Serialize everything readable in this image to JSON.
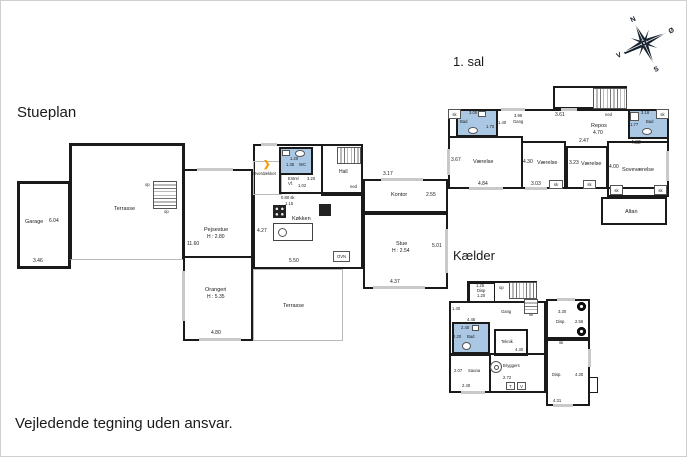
{
  "titles": {
    "ground": "Stueplan",
    "first": "1. sal",
    "basement": "Kælder"
  },
  "disclaimer": "Vejledende tegning uden ansvar.",
  "compass": {
    "north": "N",
    "east": "Ø",
    "south": "S",
    "west": "V"
  },
  "colors": {
    "bath_fill": "#aac7e4",
    "wall": "#1a1a1a",
    "window": "#c9c9c9",
    "entrance_arrow": "#f59a00"
  },
  "stueplan": {
    "garage": {
      "name": "Garage",
      "area": "6.04",
      "width": "3.46"
    },
    "terrasse_upper": {
      "name": "Terrasse",
      "stairs_up_1": "op",
      "stairs_up_2": "op"
    },
    "pejsestue": {
      "name": "Pejsestue",
      "ceiling": "H : 2.80",
      "side": "11.60"
    },
    "orangeri": {
      "name": "Orangeri",
      "ceiling": "H : 5.35",
      "width": "4.80"
    },
    "terrasse_lower": {
      "name": "Terrasse"
    },
    "overdaekket": {
      "name": "Overdækket"
    },
    "wc": {
      "name": "WC",
      "d1": "1.20",
      "d2": "1.35"
    },
    "entre": {
      "line1": "Entre/",
      "line2": "Vf.",
      "d1": "1.02",
      "d2": "3.20"
    },
    "hall": {
      "name": "Hall",
      "stairs": "ned"
    },
    "koekken": {
      "name": "Køkken",
      "island": "OPV",
      "oven": "OVN",
      "d1": "4.27",
      "d2": "0.80 sk",
      "d3": "1.15",
      "d4": "5.50"
    },
    "kontor": {
      "name": "Kontor",
      "d1": "2.55",
      "top": "3.17"
    },
    "stue": {
      "name": "Stue",
      "ceiling": "H : 2.54",
      "d1": "5.01",
      "bottom": "4.37"
    }
  },
  "first_floor": {
    "closet": "sk",
    "bad_left": {
      "name": "Bad",
      "d1": "3.00",
      "d2": "1.70"
    },
    "gang": {
      "name": "Gang",
      "d1": "3.99",
      "d2": "1.40"
    },
    "vaerelse_left": {
      "name": "Værelse",
      "d1": "3.67",
      "d2": "4.84"
    },
    "vaerelse_mid": {
      "name": "Værelse",
      "d1": "4.30",
      "d2": "3.03",
      "closet": "sk"
    },
    "vaerelse_right": {
      "name": "Værelse",
      "d1": "3.23",
      "closet": "sk"
    },
    "repos": {
      "name": "Repos",
      "d1": "4.70",
      "d2": "3.61",
      "d3": "2.47",
      "stairs": "ned"
    },
    "bad_right": {
      "name": "Bad",
      "d1": "3.16",
      "d2": "1.77",
      "closet": "sk"
    },
    "sovevaerelse": {
      "name": "Soveværelse",
      "d1": "4.00",
      "d2": "4.32",
      "closet1": "sk",
      "closet2": "sk"
    },
    "altan": {
      "name": "Altan"
    }
  },
  "basement": {
    "disp_top": {
      "name": "Disp",
      "d1": "1.25",
      "d2": "1.20"
    },
    "stairs_up": "op",
    "closet": "sk",
    "gang": {
      "name": "Gang",
      "d1": "4.45",
      "d2": "1.40"
    },
    "bad": {
      "name": "Bad",
      "d1": "2.40",
      "d2": "2.20",
      "closet": "sk"
    },
    "teknik": {
      "name": "Teknik"
    },
    "disp_right": {
      "name": "Disp.",
      "d1": "3.30",
      "d2": "2.56"
    },
    "bryggers": {
      "name": "Bryggers",
      "d1": "4.40",
      "d2": "2.72",
      "t": "T",
      "v": "V"
    },
    "sauna": {
      "name": "Sauna",
      "d1": "2.07",
      "d2": "2.40"
    },
    "disp_lower": {
      "name": "Disp.",
      "d1": "4.30",
      "d2": "4.31",
      "closet": "sk"
    }
  }
}
